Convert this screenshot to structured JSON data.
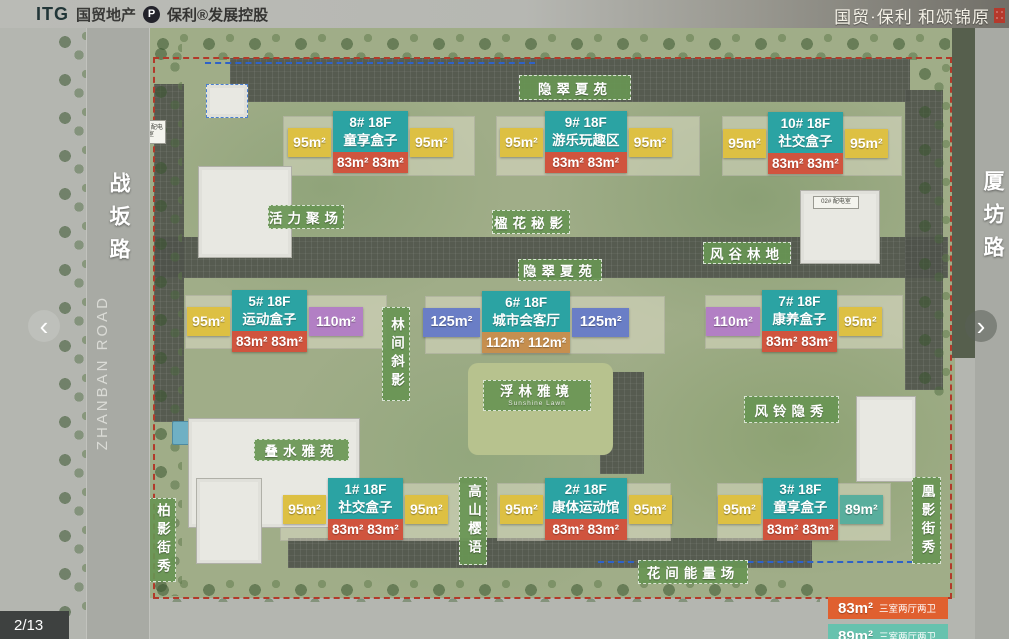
{
  "header": {
    "logo_itg": "ITG",
    "logo_itg_name": "国贸地产",
    "logo_poly_mark": "P",
    "logo_poly_name": "保利®发展控股",
    "brand": "国贸·保利 和颂锦原"
  },
  "roads": {
    "left": "战坂路",
    "left_en": "ZHANBAN ROAD",
    "right": "厦坊路"
  },
  "nav": {
    "prev": "‹",
    "next": "›"
  },
  "pagination": "2/13",
  "zones": [
    {
      "text": "隐翠夏苑"
    },
    {
      "text": "活力聚场"
    },
    {
      "text": "楹花秘影"
    },
    {
      "text": "隐翠夏苑"
    },
    {
      "text": "风谷林地"
    },
    {
      "text": "林间斜影"
    },
    {
      "text": "浮林雅境",
      "sub": "Sunshine Lawn"
    },
    {
      "text": "风铃隐秀"
    },
    {
      "text": "叠水雅苑"
    },
    {
      "text": "高山樱语"
    },
    {
      "text": "花间能量场"
    },
    {
      "text": "柏影街秀"
    },
    {
      "text": "凰影街秀"
    }
  ],
  "buildings": [
    {
      "id": "8# 18F",
      "name": "童享盒子",
      "left": "95m²",
      "center": "83m² 83m²",
      "right": "95m²"
    },
    {
      "id": "9# 18F",
      "name": "游乐玩趣区",
      "left": "95m²",
      "center": "83m² 83m²",
      "right": "95m²"
    },
    {
      "id": "10# 18F",
      "name": "社交盒子",
      "left": "95m²",
      "center": "83m² 83m²",
      "right": "95m²"
    },
    {
      "id": "5# 18F",
      "name": "运动盒子",
      "left": "95m²",
      "center": "83m² 83m²",
      "right": "110m²"
    },
    {
      "id": "6# 18F",
      "name": "城市会客厅",
      "left": "125m²",
      "center": "112m² 112m²",
      "right": "125m²"
    },
    {
      "id": "7# 18F",
      "name": "康养盒子",
      "left": "110m²",
      "center": "83m² 83m²",
      "right": "95m²"
    },
    {
      "id": "1# 18F",
      "name": "社交盒子",
      "left": "95m²",
      "center": "83m² 83m²",
      "right": "95m²"
    },
    {
      "id": "2# 18F",
      "name": "康体运动馆",
      "left": "95m²",
      "center": "83m² 83m²",
      "right": "95m²"
    },
    {
      "id": "3# 18F",
      "name": "童享盒子",
      "left": "95m²",
      "center": "83m² 83m²",
      "right": "89m²"
    }
  ],
  "utilities": [
    {
      "text": "01# 配电室"
    },
    {
      "text": "02# 配电室"
    }
  ],
  "legend": [
    {
      "area": "83m²",
      "desc": "三室两厅两卫",
      "color": "#e0602f"
    },
    {
      "area": "89m²",
      "desc": "三室两厅两卫",
      "color": "#67c2ae"
    }
  ],
  "colors": {
    "building_header_teal": "#2ba3a3",
    "unit_83_orange": "#d0543e",
    "unit_95_yellow": "#ddc043",
    "unit_110_purple": "#b27fc4",
    "unit_125_blue": "#6a7ec6",
    "unit_112_tan": "#c68f4f",
    "unit_89_teal": "#59ae9d",
    "zone_green": "#689554",
    "boundary_red": "#b23a2a"
  }
}
